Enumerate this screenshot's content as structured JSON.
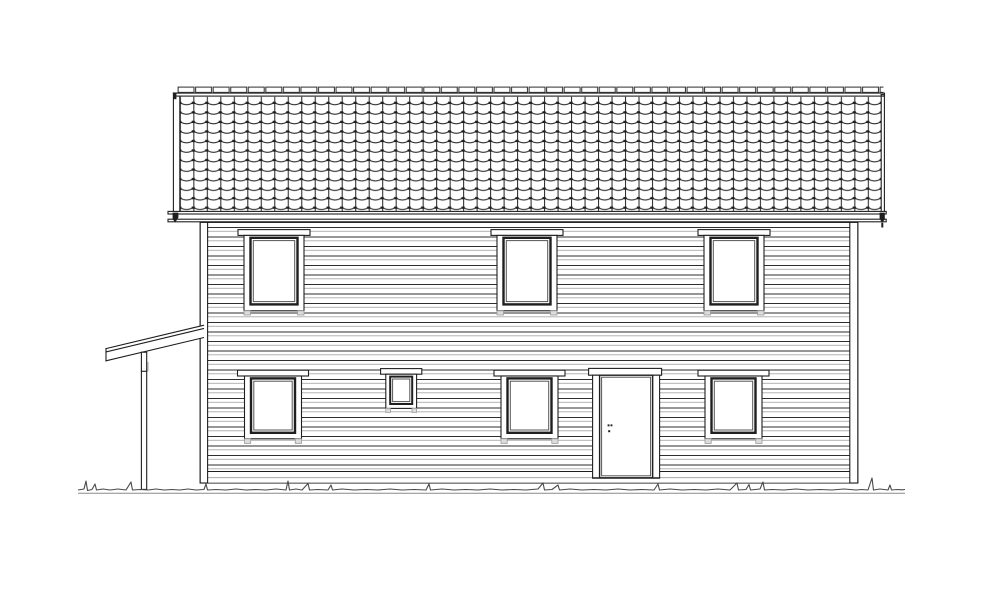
{
  "drawing": {
    "type": "architectural-elevation",
    "subject": "two-storey house, long side elevation, line drawing",
    "colors": {
      "background": "#ffffff",
      "line": "#1f1f1f",
      "line_light": "#a8a8a8",
      "shade": "#dcdcdc"
    },
    "roof": {
      "covering": "pantile-grid",
      "tile_rows": 12,
      "tile_columns": 52,
      "ridge_cap_count": 40,
      "eave_drip_ends": 2
    },
    "wall": {
      "cladding": "horizontal-weatherboard",
      "corner_boards": 2,
      "skirt_band": true
    },
    "openings": {
      "upper_windows": 3,
      "lower_windows": 3,
      "small_window": 1,
      "doors": 1,
      "door_hardware": "handle-and-lock-dots"
    },
    "porch": {
      "type": "lean-to-roof",
      "posts": 1
    },
    "ground": {
      "style": "grass-tuft-line-with-baseline"
    }
  }
}
